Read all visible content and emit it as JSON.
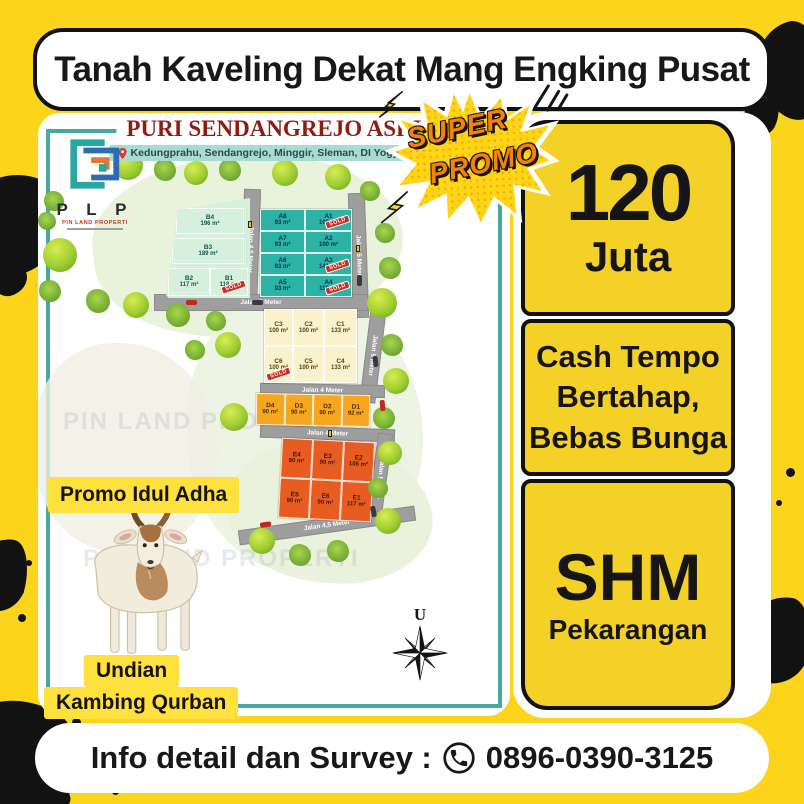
{
  "banner": {
    "title": "Tanah Kaveling Dekat Mang Engking Pusat"
  },
  "map_panel": {
    "title": "PURI SENDANGREJO ASRI",
    "address": "Kedungprahu, Sendangrejo, Minggir, Sleman, DI Yogyakarta",
    "logo": {
      "letters": "P L P",
      "name": "PIN LAND PROPERTI"
    },
    "watermark": "PIN LAND PROPERTI",
    "compass_label": "U"
  },
  "promo_burst": {
    "line1": "SUPER",
    "line2": "PROMO"
  },
  "price_panel": {
    "amount": "120",
    "unit": "Juta"
  },
  "terms_panel": {
    "line1": "Cash Tempo",
    "line2": "Bertahap,",
    "line3": "Bebas Bunga"
  },
  "cert_panel": {
    "title": "SHM",
    "subtitle": "Pekarangan"
  },
  "promo_left": {
    "top_label": "Promo Idul Adha",
    "bottom_label_line1": "Undian",
    "bottom_label_line2": "Kambing Qurban"
  },
  "footer": {
    "label": "Info detail dan Survey :",
    "phone": "0896-0390-3125"
  },
  "colors": {
    "page_yellow": "#FBD41B",
    "box_yellow": "#F4D127",
    "teal_frame": "#47A9A0",
    "section_a": "#2CB3A5",
    "section_b": "#D7EFDD",
    "section_c": "#FAF2CC",
    "section_d": "#F6A61F",
    "section_e": "#E85C22",
    "sold_red": "#D3281E"
  },
  "map": {
    "sold_label": "SOLD",
    "roads": {
      "r1": "Jalan 4,5 Meter",
      "r2": "Jalan 5 Meter",
      "r3": "Jalan 5 Meter",
      "r4": "Jalan 5 Meter",
      "r5": "Jalan 4 Meter",
      "r6": "Jalan 4 Meter",
      "r7": "Jalan 5 Meter",
      "r8": "Jalan 4,5 Meter"
    },
    "sections": {
      "b": {
        "plots": [
          {
            "id": "B4",
            "area": "196 m²"
          },
          {
            "id": "B3",
            "area": "189 m²"
          },
          {
            "id": "B2",
            "area": "117 m²"
          },
          {
            "id": "B1",
            "area": "118 m²",
            "sold": true
          }
        ]
      },
      "a": {
        "plots": [
          {
            "id": "A8",
            "area": "93 m²"
          },
          {
            "id": "A7",
            "area": "93 m²"
          },
          {
            "id": "A6",
            "area": "93 m²"
          },
          {
            "id": "A5",
            "area": "93 m²"
          },
          {
            "id": "A1",
            "area": "100 m²",
            "sold": true
          },
          {
            "id": "A2",
            "area": "100 m²"
          },
          {
            "id": "A3",
            "area": "141 m²",
            "sold": true
          },
          {
            "id": "A4",
            "area": "118 m²",
            "sold": true
          }
        ]
      },
      "c": {
        "plots": [
          {
            "id": "C3",
            "area": "100 m²"
          },
          {
            "id": "C2",
            "area": "100 m²"
          },
          {
            "id": "C1",
            "area": "133 m²"
          },
          {
            "id": "C6",
            "area": "100 m²",
            "sold": true
          },
          {
            "id": "C5",
            "area": "100 m²"
          },
          {
            "id": "C4",
            "area": "133 m²"
          }
        ]
      },
      "d": {
        "plots": [
          {
            "id": "D4",
            "area": "90 m²"
          },
          {
            "id": "D3",
            "area": "90 m²"
          },
          {
            "id": "D2",
            "area": "90 m²"
          },
          {
            "id": "D1",
            "area": "92 m²"
          }
        ]
      },
      "e": {
        "plots": [
          {
            "id": "E4",
            "area": "90 m²"
          },
          {
            "id": "E3",
            "area": "90 m²"
          },
          {
            "id": "E2",
            "area": "106 m²"
          },
          {
            "id": "E5",
            "area": "90 m²"
          },
          {
            "id": "E6",
            "area": "90 m²"
          },
          {
            "id": "E1",
            "area": "117 m²"
          }
        ]
      }
    }
  }
}
